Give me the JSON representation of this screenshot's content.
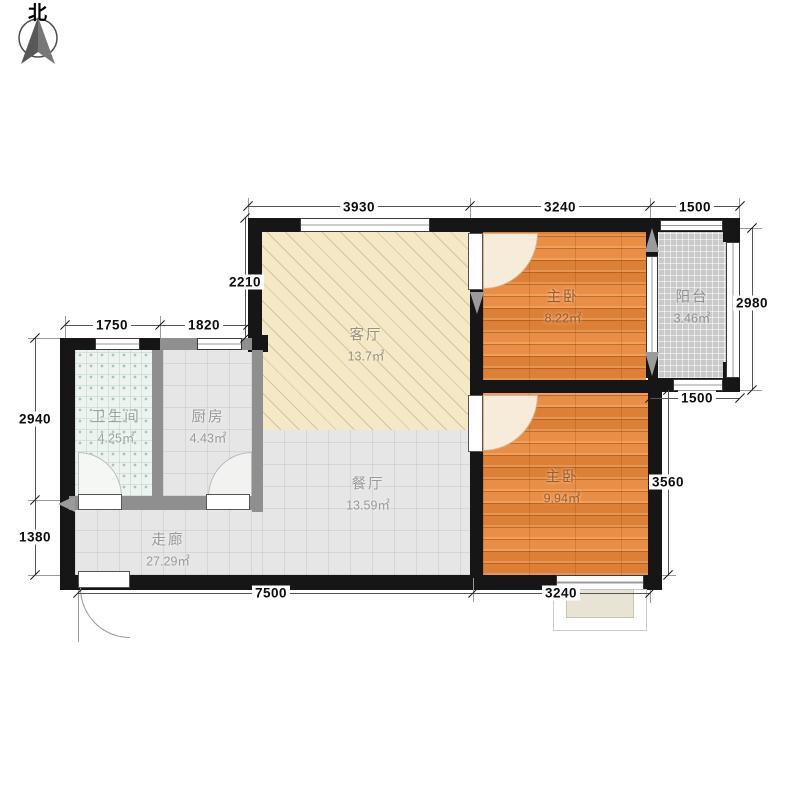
{
  "compass": {
    "label": "北"
  },
  "rooms": {
    "living": {
      "name": "客厅",
      "area": "13.7㎡"
    },
    "bedroom1": {
      "name": "主卧",
      "area": "8.22㎡"
    },
    "balcony": {
      "name": "阳台",
      "area": "3.46㎡"
    },
    "bedroom2": {
      "name": "主卧",
      "area": "9.94㎡"
    },
    "bathroom": {
      "name": "卫生间",
      "area": "4.25㎡"
    },
    "kitchen": {
      "name": "厨房",
      "area": "4.43㎡"
    },
    "dining": {
      "name": "餐厅",
      "area": "13.59㎡"
    },
    "corridor": {
      "name": "走廊",
      "area": "27.29㎡"
    }
  },
  "dimensions": {
    "top": [
      "3930",
      "3240",
      "1500"
    ],
    "right": [
      "2980",
      "1500",
      "3560"
    ],
    "left": [
      "2210",
      "2940",
      "1380"
    ],
    "inner_top": [
      "1750",
      "1820"
    ],
    "bottom": [
      "7500",
      "3240"
    ]
  },
  "colors": {
    "wall": "#161616",
    "partition": "#8f8f8f",
    "living_floor": "#f4e8c6",
    "bedroom_floor": "#e8873a",
    "tile_floor": "#e6e6e6",
    "bath_floor": "#edf3ef",
    "balcony_floor": "#c9c9c9",
    "dimension_text": "#0d0d0d"
  }
}
